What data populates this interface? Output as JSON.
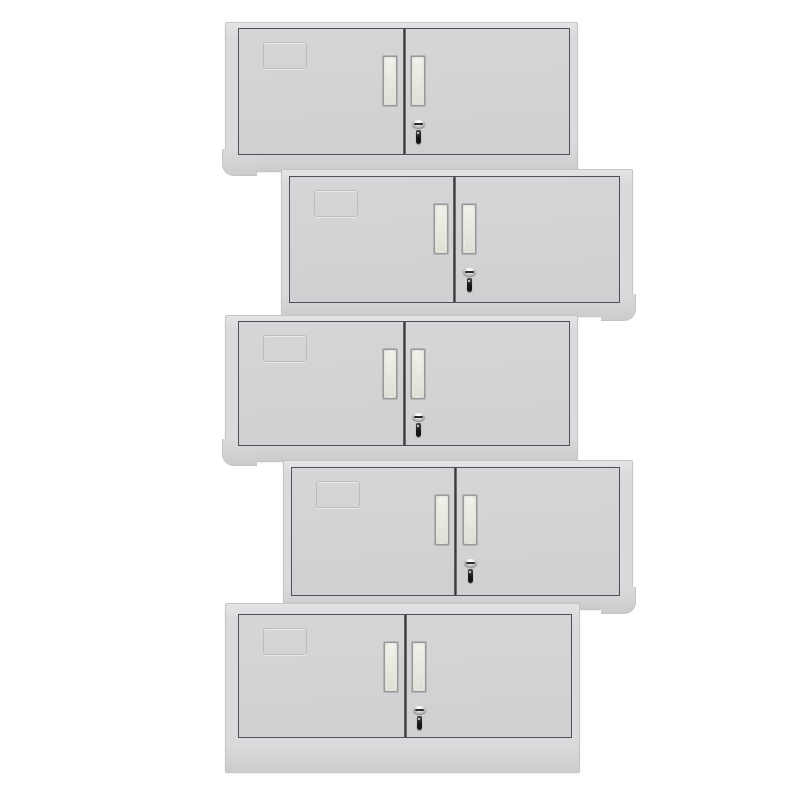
{
  "scene": {
    "description": "product photo of five identical light-gray two-door steel office cabinets stacked in an alternating zig-zag column on a white background",
    "background": "#ffffff",
    "canvas": {
      "width": 800,
      "height": 800
    },
    "colors": {
      "bg": "#ffffff",
      "frame": "#d9dadc",
      "frameHighlight": "#e3e4e6",
      "frameEdge": "#c3c4c6",
      "door": "#d5d6d8",
      "doorShade": "#cfd0d2",
      "outline": "#515155",
      "labelOutline": "#b9babc",
      "handleFace": "#edf0e6",
      "handleFaceShade": "#dde0d3",
      "handleBorder": "#999a98",
      "lockChrome": "#f2f2f2",
      "lockChromeDark": "#85868a",
      "lockSlot": "#2a2a2a",
      "key": "#161616",
      "footShade": "#cbccce"
    },
    "cabinet_parts": {
      "label_card_holder": "embossed card frame on upper-left of left door",
      "handles": "two recessed vertical pull handles flanking center divider",
      "lock": "chrome cam-lock cylinder with black key inserted, on right door below handle",
      "foot": "rounded base corner on outer side",
      "plinth": "tall base on bottom unit"
    },
    "cabinets": [
      {
        "left": 225,
        "top": 22,
        "width": 353,
        "height": 150,
        "mirrored": false,
        "foot": "left",
        "base_height": 16,
        "top_inset": 5
      },
      {
        "left": 281,
        "top": 169,
        "width": 352,
        "height": 148,
        "mirrored": true,
        "foot": "right",
        "base_height": 13,
        "top_inset": 6
      },
      {
        "left": 225,
        "top": 315,
        "width": 353,
        "height": 147,
        "mirrored": false,
        "foot": "left",
        "base_height": 15,
        "top_inset": 5
      },
      {
        "left": 283,
        "top": 460,
        "width": 350,
        "height": 150,
        "mirrored": true,
        "foot": "right",
        "base_height": 13,
        "top_inset": 6
      },
      {
        "left": 225,
        "top": 603,
        "width": 355,
        "height": 170,
        "mirrored": false,
        "foot": "none",
        "base_height": 34,
        "top_inset": 10
      }
    ]
  }
}
